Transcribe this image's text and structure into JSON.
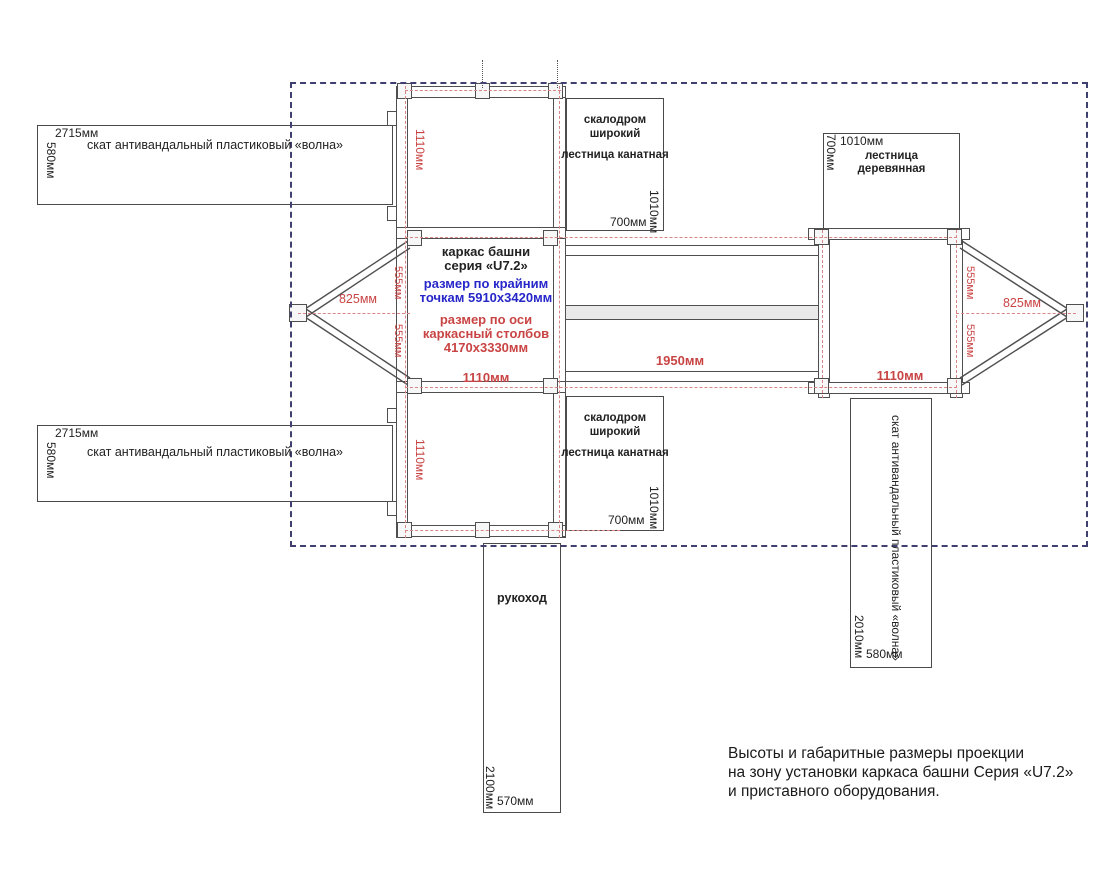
{
  "caption": {
    "line1": "Высоты и габаритные размеры проекции",
    "line2": "на зону установки каркаса башни Серия «U7.2»",
    "line3": "и  приставного оборудования."
  },
  "center_block": {
    "line1": "каркас башни",
    "line2": "серия «U7.2»",
    "line3": "размер по крайним",
    "line4": "точкам 5910х3420мм",
    "line5": "размер по оси",
    "line6": "каркасный столбов",
    "line7": "4170х3330мм",
    "dim_bottom": "1110мм"
  },
  "dimensions": {
    "square_top_v": "1110мм",
    "square_bottom_v": "1110мм",
    "right_tower_bottom": "1110мм",
    "bridge_length": "1950мм",
    "left_apex": "825мм",
    "right_apex": "825мм",
    "left_555_top": "555мм",
    "left_555_bottom": "555мм",
    "right_555_top": "555мм",
    "right_555_bottom": "555мм"
  },
  "equipment": {
    "slide_top": {
      "name": "скат антивандальный пластиковый «волна»",
      "length": "2715мм",
      "width": "580мм"
    },
    "slide_bottom": {
      "name": "скат антивандальный пластиковый «волна»",
      "length": "2715мм",
      "width": "580мм"
    },
    "climb_top": {
      "line1": "скалодром",
      "line2": "широкий",
      "line3": "лестница канатная",
      "width": "1010мм",
      "depth": "700мм"
    },
    "climb_bottom": {
      "line1": "скалодром",
      "line2": "широкий",
      "line3": "лестница канатная",
      "width": "1010мм",
      "depth": "700мм"
    },
    "wood_ladder": {
      "line1": "лестница",
      "line2": "деревянная",
      "width": "1010мм",
      "depth": "700мм"
    },
    "slide_right": {
      "name": "скат антивандальный пластиковый «волна»",
      "length": "2010мм",
      "width": "580мм"
    },
    "monkey_bars": {
      "name": "рукоход",
      "length": "2100мм",
      "width": "570мм"
    }
  }
}
